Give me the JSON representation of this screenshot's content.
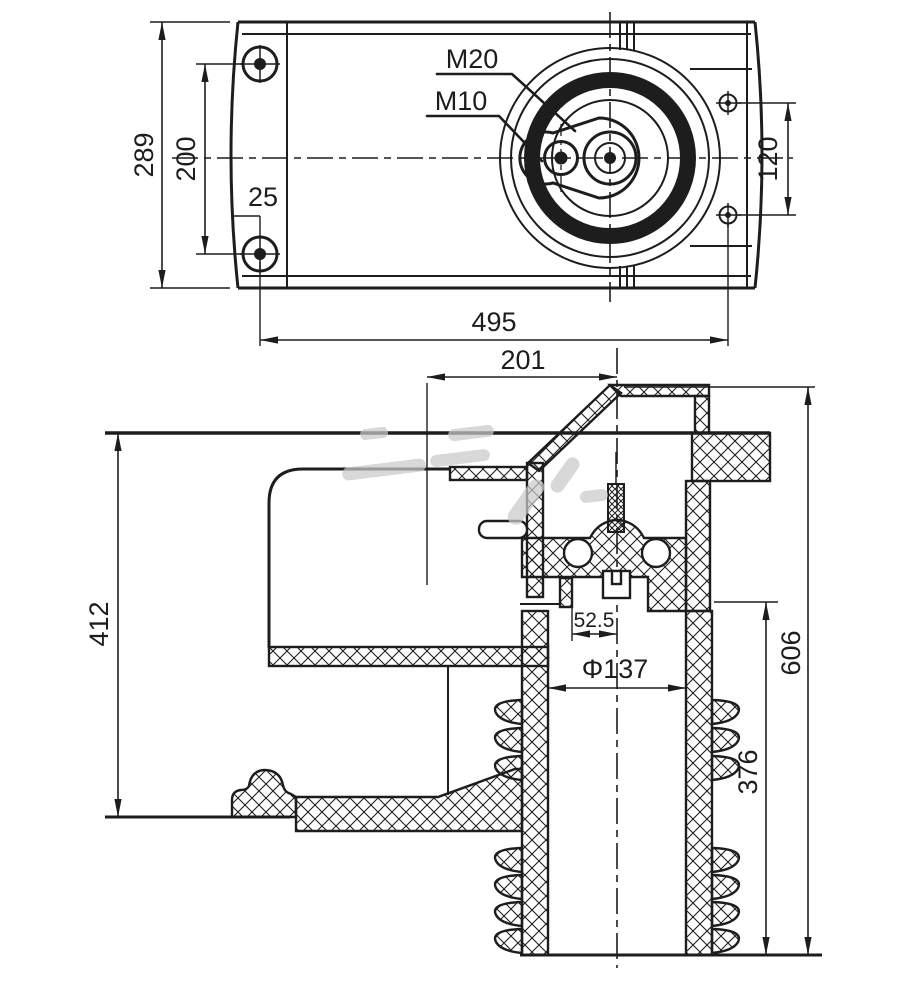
{
  "colors": {
    "line": "#1d1d1d",
    "background": "#ffffff",
    "watermark": "#c9c9c9"
  },
  "top_view": {
    "dim_overall_height": "289",
    "dim_bolt_spacing_left": "200",
    "dim_edge_offset": "25",
    "dim_overall_width": "495",
    "dim_bolt_spacing_right": "120",
    "thread_label_large": "M20",
    "thread_label_small": "M10"
  },
  "side_view": {
    "dim_terminal_offset": "201",
    "dim_housing_height": "412",
    "dim_contact_offset": "52.5",
    "dim_bore_diameter": "Φ137",
    "dim_total_height": "606",
    "dim_lower_height": "376"
  }
}
